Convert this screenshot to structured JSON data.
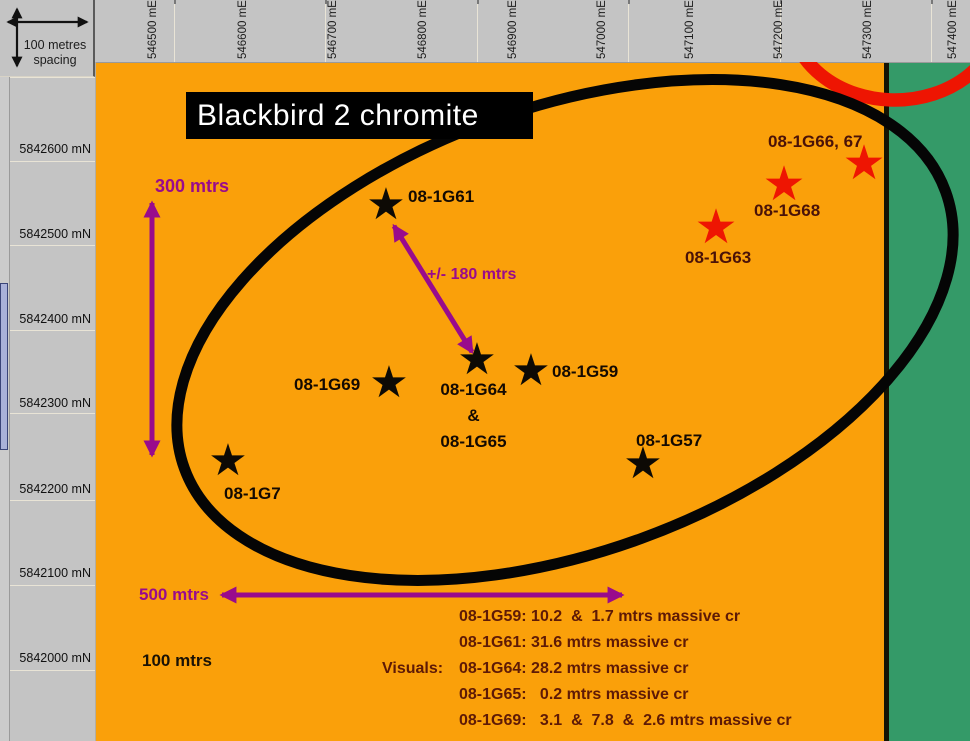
{
  "title": "Blackbird 2 chromite",
  "corner": {
    "line1": "100 metres",
    "line2": "spacing"
  },
  "axes": {
    "easting": [
      {
        "label": "546500 mE"
      },
      {
        "label": "546600 mE"
      },
      {
        "label": "546700 mE"
      },
      {
        "label": "546800 mE"
      },
      {
        "label": "546900 mE"
      },
      {
        "label": "547000 mE"
      },
      {
        "label": "547100 mE"
      },
      {
        "label": "547200 mE"
      },
      {
        "label": "547300 mE"
      },
      {
        "label": "547400 mE"
      }
    ],
    "northing": [
      {
        "label": "5842600 mN"
      },
      {
        "label": "5842500 mN"
      },
      {
        "label": "5842400 mN"
      },
      {
        "label": "5842300 mN"
      },
      {
        "label": "5842200 mN"
      },
      {
        "label": "5842100 mN"
      },
      {
        "label": "5842000 mN"
      }
    ]
  },
  "measurements": {
    "vertical": "300 mtrs",
    "diagonal": "+/- 180 mtrs",
    "horizontal": "500 mtrs",
    "grid": "100 mtrs"
  },
  "glyphs": {
    "star": "★"
  },
  "holes": {
    "black": [
      {
        "label": "08-1G61"
      },
      {
        "label": "08-1G69"
      },
      {
        "lines": [
          "08-1G64",
          "&",
          "08-1G65"
        ]
      },
      {
        "label": "08-1G59"
      },
      {
        "label": "08-1G57"
      },
      {
        "label": "08-1G7"
      }
    ],
    "red": [
      {
        "label": "08-1G66, 67"
      },
      {
        "label": "08-1G68"
      },
      {
        "label": "08-1G63"
      }
    ]
  },
  "visuals": {
    "heading": "Visuals:",
    "lines": [
      "08-1G59: 10.2  &  1.7 mtrs massive cr",
      "08-1G61: 31.6 mtrs massive cr",
      "08-1G64: 28.2 mtrs massive cr",
      "08-1G65:   0.2 mtrs massive cr",
      "08-1G69:   3.1  &  7.8  &  2.6 mtrs massive cr"
    ]
  },
  "colors": {
    "orange": "#FAA00A",
    "green": "#349A68",
    "panel_gray": "#C4C4C4",
    "purple": "#990B8C",
    "red": "#EE1502",
    "dark_red_text": "#5E1A06",
    "selection_blue": "#A9B1D9"
  }
}
